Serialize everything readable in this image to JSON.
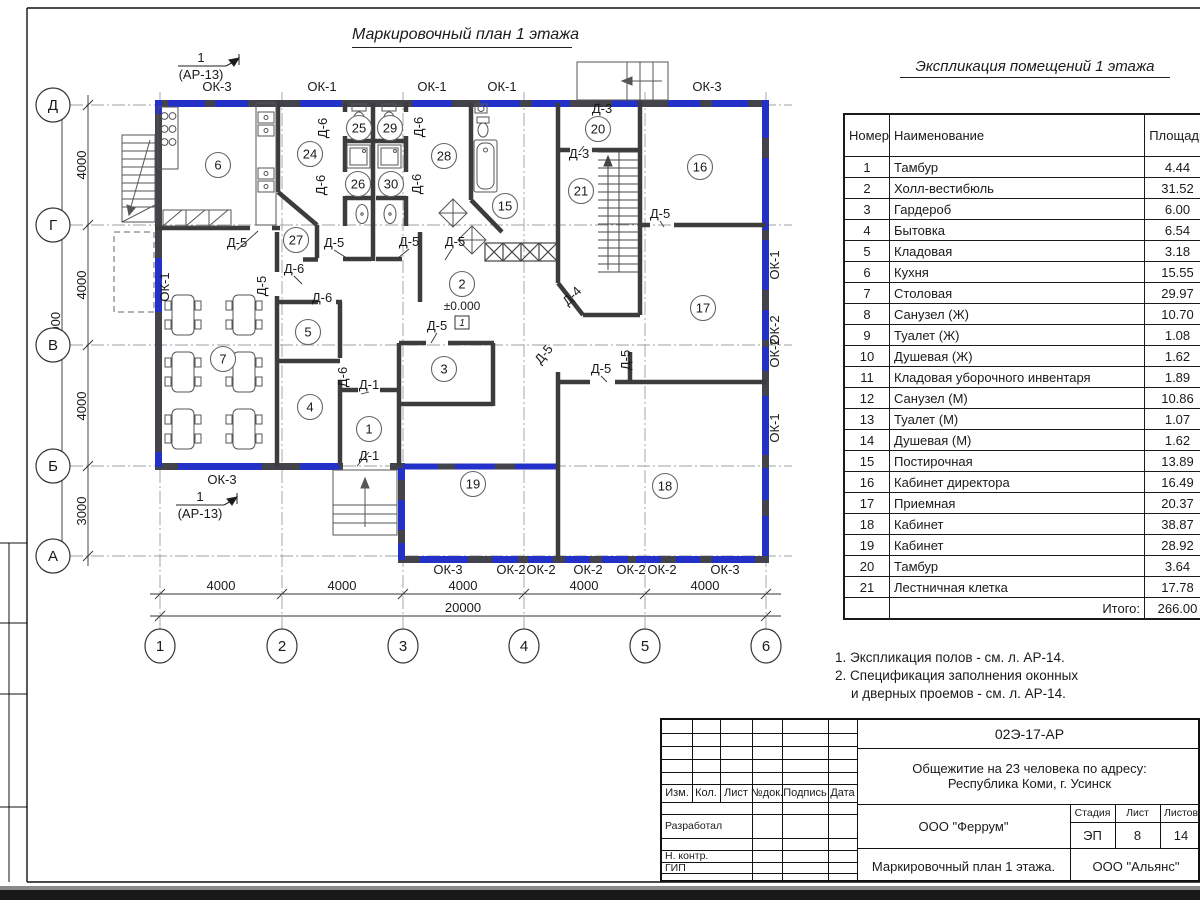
{
  "colors": {
    "accent_blue": "#2431c8",
    "wall_dark": "#40404a",
    "line": "#1a1a1a"
  },
  "plan": {
    "title": "Маркировочный план 1 этажа",
    "level_mark": "±0.000",
    "level_flag": "1",
    "section_marker": {
      "num": "1",
      "sheet": "(АР-13)"
    },
    "axes_rows": [
      {
        "t": "Д",
        "y": 105
      },
      {
        "t": "Г",
        "y": 225
      },
      {
        "t": "В",
        "y": 345
      },
      {
        "t": "Б",
        "y": 466
      },
      {
        "t": "А",
        "y": 556
      }
    ],
    "axes_cols": [
      {
        "t": "1",
        "x": 160
      },
      {
        "t": "2",
        "x": 282
      },
      {
        "t": "3",
        "x": 403
      },
      {
        "t": "4",
        "x": 524
      },
      {
        "t": "5",
        "x": 645
      },
      {
        "t": "6",
        "x": 766
      }
    ],
    "dims_left": [
      "4000",
      "4000",
      "4000",
      "3000"
    ],
    "total_left": "15000",
    "dims_bottom": [
      "4000",
      "4000",
      "4000",
      "4000",
      "4000"
    ],
    "total_bottom": "20000",
    "rooms": [
      {
        "n": "6",
        "x": 218,
        "y": 165
      },
      {
        "n": "24",
        "x": 310,
        "y": 154
      },
      {
        "n": "25",
        "x": 359,
        "y": 128
      },
      {
        "n": "29",
        "x": 390,
        "y": 128
      },
      {
        "n": "26",
        "x": 358,
        "y": 184
      },
      {
        "n": "30",
        "x": 391,
        "y": 184
      },
      {
        "n": "28",
        "x": 444,
        "y": 156
      },
      {
        "n": "27",
        "x": 296,
        "y": 240
      },
      {
        "n": "15",
        "x": 505,
        "y": 206
      },
      {
        "n": "20",
        "x": 598,
        "y": 129
      },
      {
        "n": "21",
        "x": 581,
        "y": 191
      },
      {
        "n": "16",
        "x": 700,
        "y": 167
      },
      {
        "n": "17",
        "x": 703,
        "y": 308
      },
      {
        "n": "2",
        "x": 462,
        "y": 284
      },
      {
        "n": "5",
        "x": 308,
        "y": 332
      },
      {
        "n": "7",
        "x": 223,
        "y": 359
      },
      {
        "n": "3",
        "x": 444,
        "y": 369
      },
      {
        "n": "4",
        "x": 310,
        "y": 407
      },
      {
        "n": "1",
        "x": 369,
        "y": 429
      },
      {
        "n": "19",
        "x": 473,
        "y": 484
      },
      {
        "n": "18",
        "x": 665,
        "y": 486
      }
    ],
    "window_labels": [
      {
        "t": "ОК-3",
        "x": 217,
        "y": 91
      },
      {
        "t": "ОК-1",
        "x": 322,
        "y": 91
      },
      {
        "t": "ОК-1",
        "x": 432,
        "y": 91
      },
      {
        "t": "ОК-1",
        "x": 502,
        "y": 91
      },
      {
        "t": "ОК-3",
        "x": 707,
        "y": 91
      },
      {
        "t": "ОК-3",
        "x": 448,
        "y": 574
      },
      {
        "t": "ОК-2",
        "x": 511,
        "y": 574
      },
      {
        "t": "ОК-2",
        "x": 541,
        "y": 574
      },
      {
        "t": "ОК-2",
        "x": 588,
        "y": 574
      },
      {
        "t": "ОК-2",
        "x": 631,
        "y": 574
      },
      {
        "t": "ОК-2",
        "x": 662,
        "y": 574
      },
      {
        "t": "ОК-3",
        "x": 725,
        "y": 574
      },
      {
        "t": "ОК-1",
        "x": 779,
        "y": 265,
        "rot": -90
      },
      {
        "t": "ОК-2",
        "x": 779,
        "y": 330,
        "rot": -90
      },
      {
        "t": "ОК-2",
        "x": 779,
        "y": 353,
        "rot": -90
      },
      {
        "t": "ОК-1",
        "x": 779,
        "y": 428,
        "rot": -90
      },
      {
        "t": "ОК-1",
        "x": 169,
        "y": 287,
        "rot": -90
      },
      {
        "t": "ОК-3",
        "x": 222,
        "y": 484
      }
    ],
    "door_labels": [
      {
        "t": "Д-5",
        "x": 237,
        "y": 247
      },
      {
        "t": "Д-5",
        "x": 334,
        "y": 247
      },
      {
        "t": "Д-5",
        "x": 409,
        "y": 246
      },
      {
        "t": "Д-5",
        "x": 455,
        "y": 246
      },
      {
        "t": "Д-5",
        "x": 266,
        "y": 286,
        "rot": -90
      },
      {
        "t": "Д-5",
        "x": 437,
        "y": 330
      },
      {
        "t": "Д-5",
        "x": 660,
        "y": 218
      },
      {
        "t": "Д-5",
        "x": 547,
        "y": 357,
        "rot": -50
      },
      {
        "t": "Д-5",
        "x": 601,
        "y": 373
      },
      {
        "t": "Д-5",
        "x": 630,
        "y": 360,
        "rot": -90
      },
      {
        "t": "Д-6",
        "x": 327,
        "y": 128,
        "rot": -90
      },
      {
        "t": "Д-6",
        "x": 423,
        "y": 127,
        "rot": -90
      },
      {
        "t": "Д-6",
        "x": 325,
        "y": 185,
        "rot": -90
      },
      {
        "t": "Д-6",
        "x": 421,
        "y": 184,
        "rot": -90
      },
      {
        "t": "Д-6",
        "x": 294,
        "y": 273
      },
      {
        "t": "Д-6",
        "x": 322,
        "y": 302
      },
      {
        "t": "Д-6",
        "x": 347,
        "y": 377,
        "rot": -90
      },
      {
        "t": "Д-3",
        "x": 602,
        "y": 113
      },
      {
        "t": "Д-3",
        "x": 579,
        "y": 158
      },
      {
        "t": "Д-1",
        "x": 369,
        "y": 389
      },
      {
        "t": "Д-1",
        "x": 369,
        "y": 460
      },
      {
        "t": "Д-4",
        "x": 575,
        "y": 299,
        "rot": -45
      }
    ]
  },
  "explication": {
    "title": "Экспликация помещений 1 этажа",
    "headers": {
      "num": "Номер помещ.",
      "name": "Наименование",
      "area": "Площадь",
      "cat1": "Ка",
      "cat2": "по"
    },
    "rows": [
      [
        "1",
        "Тамбур",
        "4.44"
      ],
      [
        "2",
        "Холл-вестибюль",
        "31.52"
      ],
      [
        "3",
        "Гардероб",
        "6.00"
      ],
      [
        "4",
        "Бытовка",
        "6.54"
      ],
      [
        "5",
        "Кладовая",
        "3.18"
      ],
      [
        "6",
        "Кухня",
        "15.55"
      ],
      [
        "7",
        "Столовая",
        "29.97"
      ],
      [
        "8",
        "Санузел (Ж)",
        "10.70"
      ],
      [
        "9",
        "Туалет (Ж)",
        "1.08"
      ],
      [
        "10",
        "Душевая (Ж)",
        "1.62"
      ],
      [
        "11",
        "Кладовая уборочного инвентаря",
        "1.89"
      ],
      [
        "12",
        "Санузел (М)",
        "10.86"
      ],
      [
        "13",
        "Туалет (М)",
        "1.07"
      ],
      [
        "14",
        "Душевая (М)",
        "1.62"
      ],
      [
        "15",
        "Постирочная",
        "13.89"
      ],
      [
        "16",
        "Кабинет директора",
        "16.49"
      ],
      [
        "17",
        "Приемная",
        "20.37"
      ],
      [
        "18",
        "Кабинет",
        "38.87"
      ],
      [
        "19",
        "Кабинет",
        "28.92"
      ],
      [
        "20",
        "Тамбур",
        "3.64"
      ],
      [
        "21",
        "Лестничная клетка",
        "17.78"
      ]
    ],
    "total_label": "Итого:",
    "total_value": "266.00"
  },
  "notes": [
    "1. Экспликация полов - см. л. АР-14.",
    "2. Спецификация заполнения оконных",
    "и дверных проемов - см. л. АР-14."
  ],
  "titleblock": {
    "doc_code": "02Э-17-АР",
    "project_line1": "Общежитие на 23 человека по адресу:",
    "project_line2": "Республика Коми, г. Усинск",
    "org_designer": "ООО \"Феррум\"",
    "org_customer": "ООО \"Альянс\"",
    "sheet_title": "Маркировочный план 1 этажа.",
    "cols": [
      "Изм.",
      "Кол.",
      "Лист",
      "№док.",
      "Подпись",
      "Дата"
    ],
    "roles": [
      "Разработал",
      "Н. контр.",
      "ГИП"
    ],
    "stage_label": "Стадия",
    "stage": "ЭП",
    "sheet_label": "Лист",
    "sheet_num": "8",
    "sheets_label": "Листов",
    "sheets_total": "14"
  }
}
